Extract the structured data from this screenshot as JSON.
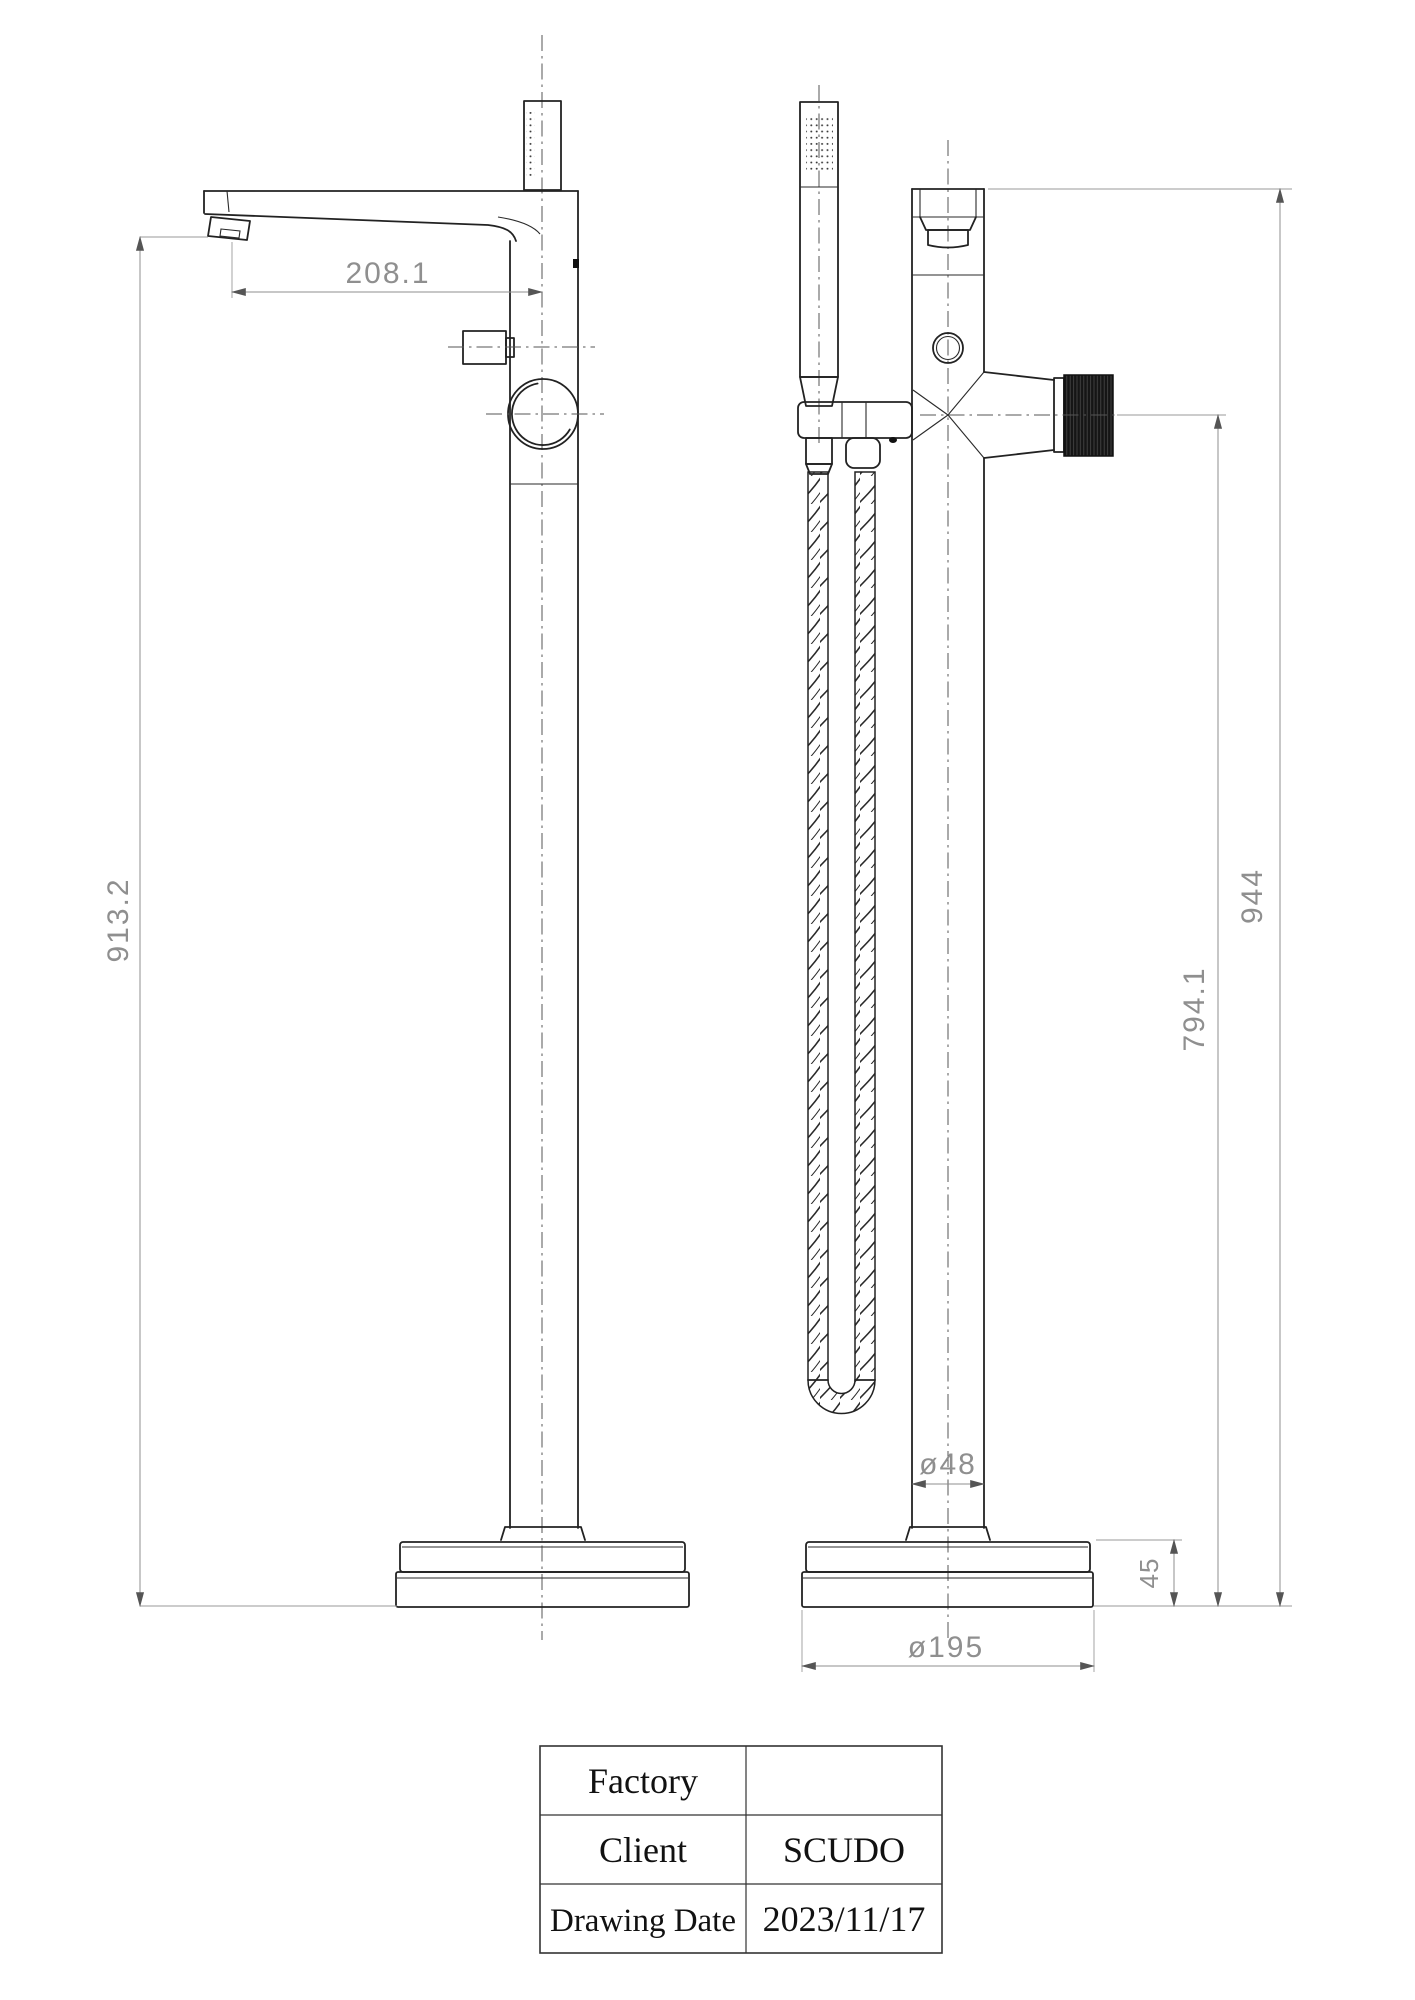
{
  "dimensions": {
    "spout_reach": "208.1",
    "outlet_height": "913.2",
    "overall_height": "944",
    "handle_centre_height": "794.1",
    "column_diameter": "ø48",
    "base_height": "45",
    "base_diameter": "ø195"
  },
  "title_block": {
    "rows": [
      {
        "label": "Factory",
        "value": ""
      },
      {
        "label": "Client",
        "value": "SCUDO"
      },
      {
        "label": "Drawing Date",
        "value": "2023/11/17"
      }
    ]
  },
  "colors": {
    "object_line": "#222222",
    "dimension_line": "#8f8f8f",
    "centerline": "#555555",
    "knob_fill": "#151515",
    "background": "#ffffff"
  }
}
